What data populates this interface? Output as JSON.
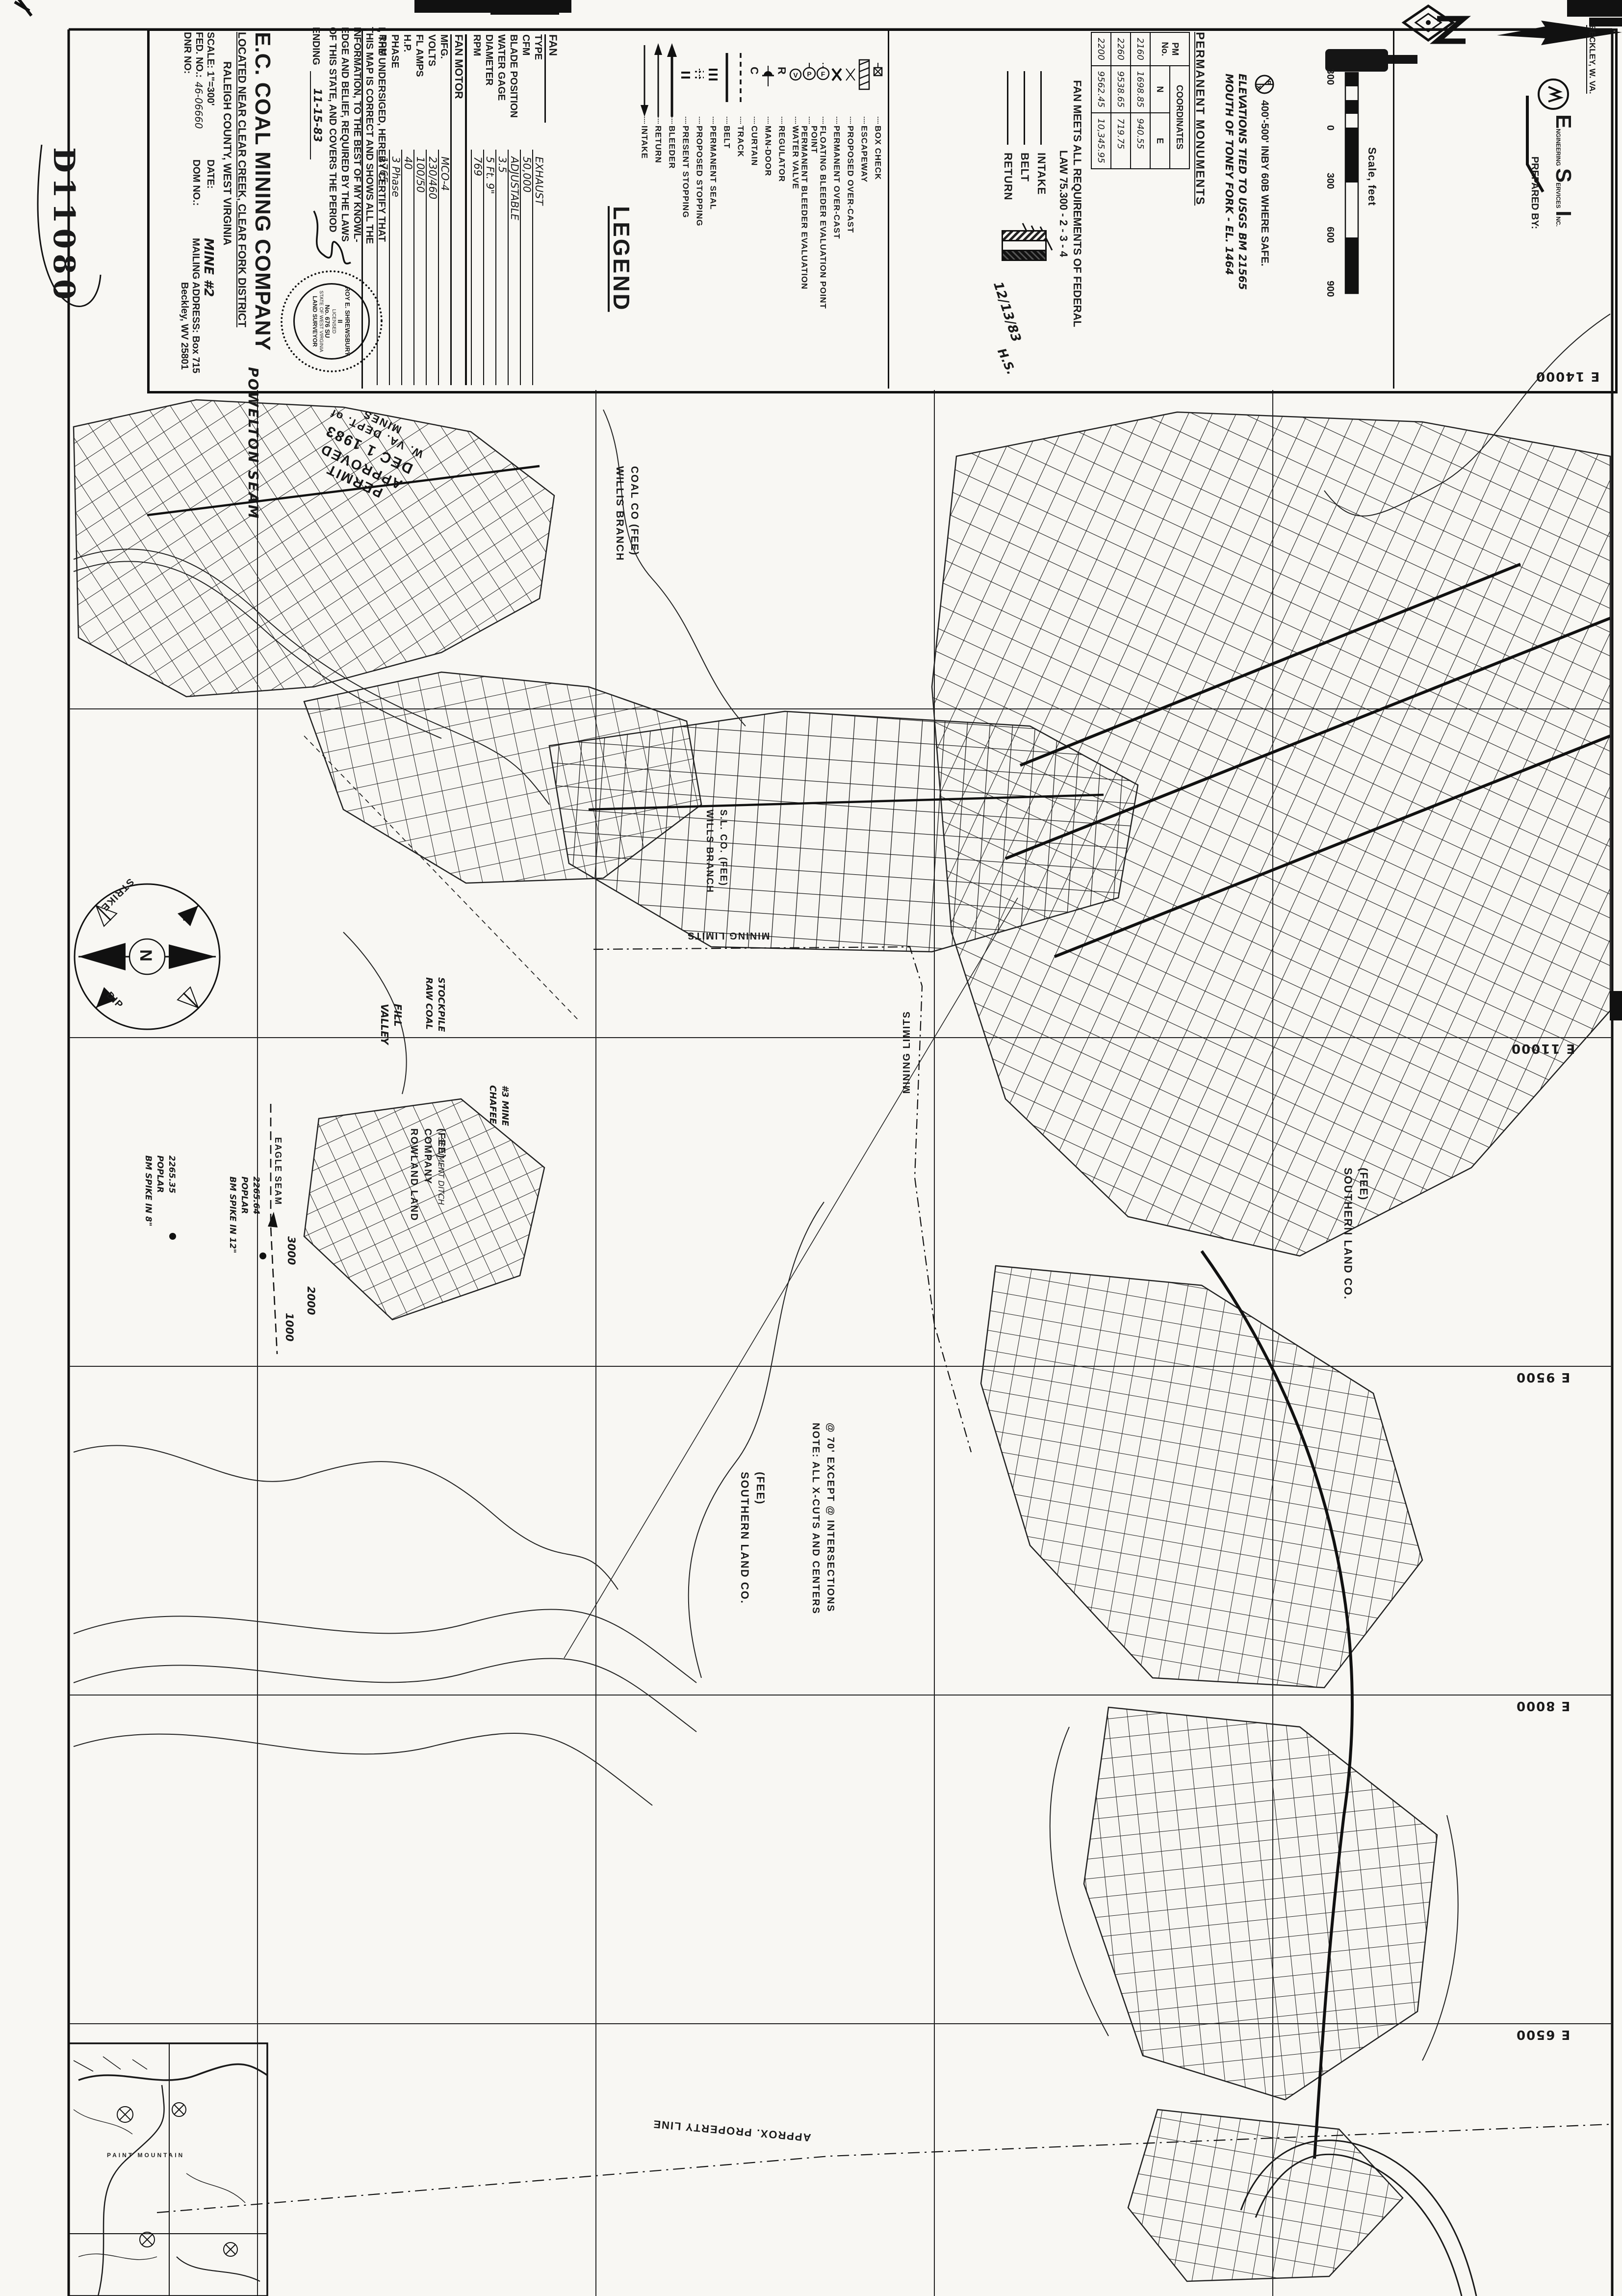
{
  "document_number": "D11080",
  "company": {
    "title": "E.C. COAL MINING COMPANY",
    "located": "LOCATED NEAR CLEAR CREEK, CLEAR FORK DISTRICT",
    "county": "RALEIGH COUNTY, WEST VIRGINIA",
    "scale_label": "SCALE: 1\"=300'",
    "fed_label": "FED. NO.:",
    "fed_no": "46-06660",
    "dnr_label": "DNR NO:",
    "date_label": "DATE:",
    "dom_label": "DOM NO.:",
    "mine": "MINE #2",
    "mailing": "MAILING ADDRESS: Box 715",
    "city": "Beckley, WV 25801",
    "seam": "POWELTON SEAM"
  },
  "certification": {
    "text": "I, THE UNDERSIGED, HEREBY CERTIFY THAT THIS MAP IS CORRECT AND SHOWS ALL THE INFORMATION, TO THE BEST OF MY KNOWL-EDGE AND BELIEF, REQUIRED BY THE LAWS OF THIS STATE, AND COVERS THE PERIOD",
    "ending_label": "ENDING",
    "ending_date": "11-15-83",
    "seal": {
      "name": "ROY E. SHREWSBURY II",
      "license": "No. 676 SU",
      "licensed": "LICENSED",
      "state": "STATE OF WEST VIRGINIA",
      "title": "LAND SURVEYOR"
    }
  },
  "fan": {
    "header": "FAN",
    "rows": [
      {
        "label": "TYPE",
        "value": "EXHAUST"
      },
      {
        "label": "CFM",
        "value": "50,000"
      },
      {
        "label": "BLADE POSITION",
        "value": "ADJUSTABLE"
      },
      {
        "label": "WATER GAGE",
        "value": "3.5"
      },
      {
        "label": "DIAMETER",
        "value": "5 Ft. 9\""
      },
      {
        "label": "RPM",
        "value": "769"
      }
    ],
    "motor_header": "FAN MOTOR",
    "motor_rows": [
      {
        "label": "MFG.",
        "value": "MCO-4"
      },
      {
        "label": "VOLTS",
        "value": "230/460"
      },
      {
        "label": "FL AMPS",
        "value": "100/50"
      },
      {
        "label": "H.P.",
        "value": "40"
      },
      {
        "label": "PHASE",
        "value": "3 Phase"
      },
      {
        "label": "RPM",
        "value": "1765"
      }
    ]
  },
  "legend": {
    "title": "LEGEND",
    "items": [
      {
        "label": "INTAKE",
        "symbol": "arrow-down"
      },
      {
        "label": "RETURN",
        "symbol": "arrow-up"
      },
      {
        "label": "BLEEDER",
        "symbol": "arrow-up-bold"
      },
      {
        "label": "PRESENT STOPPING",
        "symbol": "double-bar"
      },
      {
        "label": "PROPOSED STOPPING",
        "symbol": "double-bar-dashed"
      },
      {
        "label": "PERMANENT SEAL",
        "symbol": "triple-bar"
      },
      {
        "label": "BELT",
        "symbol": "solid-line"
      },
      {
        "label": "TRACK",
        "symbol": "dashed-line"
      },
      {
        "label": "CURTAIN",
        "symbol": "letter-c"
      },
      {
        "label": "MAN-DOOR",
        "symbol": "half-moon"
      },
      {
        "label": "REGULATOR",
        "symbol": "letter-r"
      },
      {
        "label": "WATER VALVE",
        "symbol": "circle-v"
      },
      {
        "label": "PERMANENT BLEEDER EVALUATION POINT",
        "symbol": "circle-p"
      },
      {
        "label": "FLOATING BLEEDER EVALUATION POINT",
        "symbol": "circle-f"
      },
      {
        "label": "PERMANENT OVER-CAST",
        "symbol": "x-solid"
      },
      {
        "label": "PROPOSED OVER-CAST",
        "symbol": "x-light"
      },
      {
        "label": "ESCAPEWAY",
        "symbol": "hatched-box"
      },
      {
        "label": "BOX CHECK",
        "symbol": "box-x"
      }
    ]
  },
  "fan_note": "FAN MEETS ALL REQUIREMENTS OF FEDERAL\nLAW  75.300 - 2 - 3 - 4",
  "airway_key": [
    {
      "label": "INTAKE"
    },
    {
      "label": "BELT"
    },
    {
      "label": "RETURN"
    }
  ],
  "checked_date": "12/13/83",
  "checked_initials": "H.S.",
  "monuments": {
    "title": "PERMANENT  MONUMENTS",
    "col_pm": "PM\nNo.",
    "col_coord": "COORDINATES",
    "rows": [
      [
        "2160",
        "1698.85",
        "940.55"
      ],
      [
        "2260",
        "9538.65",
        "719.75"
      ],
      [
        "2200",
        "9562.45",
        "10,345.95"
      ]
    ]
  },
  "notes": {
    "monument_note": "400'-500' INBY 60B WHERE SAFE.",
    "elevation_note": "ELEVATIONS TIED TO USGS BM 21565\nMOUTH OF TONEY FORK - EL. 1464"
  },
  "scalebar": {
    "ticks": [
      "300",
      "0",
      "300",
      "600",
      "900"
    ],
    "caption": "Scale, feet"
  },
  "prepared_by": {
    "label": "PREPARED BY:",
    "e": "E",
    "e_rest": "NGINEERING",
    "s": "S",
    "s_rest": "ERVICES",
    "i": "I",
    "i_rest": "NC.",
    "city": "BECKLEY, W. VA."
  },
  "grid_labels": {
    "e14000": "E 14000",
    "e11000": "E 11000",
    "e9500": "E 9500",
    "e8000": "E 8000",
    "e6500": "E 6500"
  },
  "stamp": {
    "line1": "PERMIT APPROVED",
    "line2": "DEC 1 1983",
    "line3": "W. VA. DEPT. of MINES"
  },
  "compass": {
    "n": "N",
    "strike": "STRIKE",
    "dip": "DIP"
  },
  "map_labels": {
    "willis_branch": "WILLIS BRANCH\nCOAL CO (FEE)",
    "wills_sl": "WILLS BRANCH\nS.L. CO. (FEE)",
    "mining_limits_h": "MINING LIMITS",
    "mining_limits_v": "MINING LIMITS",
    "valley_fill": "VALLEY\nFILL",
    "raw_coal": "RAW COAL\nSTOCKPILE",
    "chafee": "CHAFEE\n#3 MINE",
    "rowland": "ROWLAND LAND\nCOMPANY\n(FEE)",
    "sediment": "SEDIMENT DITCH",
    "eagle_seam": "EAGLE SEAM",
    "bm8": "BM SPIKE IN 8\"\nPOPLAR\n2265.35",
    "bm12": "BM SPIKE IN 12\"\nPOPLAR\n2265.64",
    "q3000": "3000",
    "q2000": "2000",
    "q1000": "1000",
    "southern1": "SOUTHERN LAND CO.\n(FEE)",
    "southern2": "SOUTHERN LAND CO.\n(FEE)",
    "note_xcuts": "NOTE: ALL X-CUTS AND CENTERS\n@ 70' EXCEPT @ INTERSECTIONS",
    "property_line": "APPROX.  PROPERTY  LINE",
    "paint_mountain": "PAINT  MOUNTAIN"
  }
}
